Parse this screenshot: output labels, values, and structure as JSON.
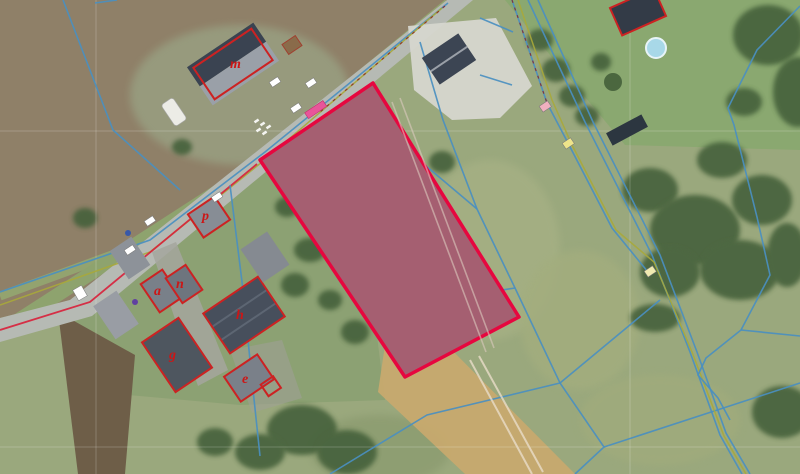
{
  "map": {
    "kind": "aerial cadastral map with highlighted parcel",
    "selected_parcel": {
      "shape": "rotated rectangle",
      "status": "highlighted"
    },
    "buildings": [
      {
        "label": "m"
      },
      {
        "label": "p"
      },
      {
        "label": "a"
      },
      {
        "label": "n"
      },
      {
        "label": "h"
      },
      {
        "label": "g"
      },
      {
        "label": "e"
      }
    ]
  },
  "colors": {
    "parcel_fill": "#c04a82",
    "parcel_outline": "#e6073f",
    "cadastral_line": "#4a8fc0",
    "utility_line": "#a8a83a",
    "building_outline": "#cc2222",
    "label_color": "#cc1616",
    "parcel_tag": "#e8559a",
    "marker_white": "#ffffff",
    "marker_yellow": "#eee48a",
    "marker_pink": "#f0b0c0"
  },
  "markers": {
    "road_labels": "small white cadastral marker boxes along road",
    "yellow_points": "yellow boundary point markers",
    "pink_point": "pink boundary point marker",
    "parcel_tag": "small magenta tag on highlighted parcel"
  }
}
